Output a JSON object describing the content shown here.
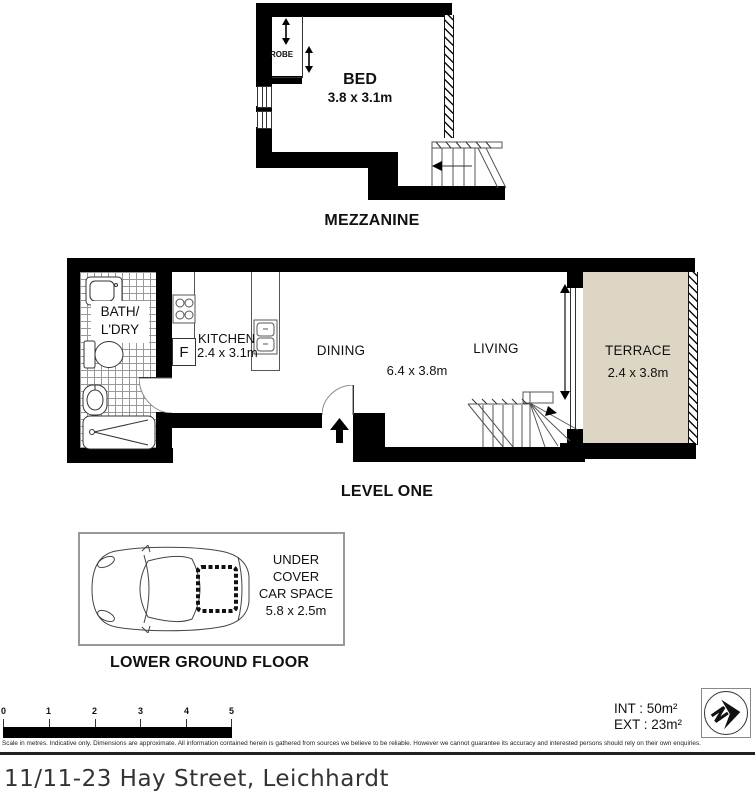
{
  "floors": {
    "mezzanine": {
      "title": "MEZZANINE",
      "bed": {
        "name": "BED",
        "dims": "3.8 x 3.1m"
      },
      "robe": {
        "name": "ROBE"
      }
    },
    "level_one": {
      "title": "LEVEL ONE",
      "bath": {
        "line1": "BATH/",
        "line2": "L'DRY"
      },
      "kitchen": {
        "name": "KITCHEN",
        "dims": "2.4 x 3.1m",
        "fridge": "F"
      },
      "dining": {
        "name": "DINING",
        "dims": "6.4 x 3.8m"
      },
      "living": {
        "name": "LIVING"
      },
      "terrace": {
        "name": "TERRACE",
        "dims": "2.4 x 3.8m"
      }
    },
    "lower_ground": {
      "title": "LOWER GROUND FLOOR",
      "car_space": {
        "line1": "UNDER",
        "line2": "COVER",
        "line3": "CAR SPACE",
        "dims": "5.8 x 2.5m"
      }
    }
  },
  "footer": {
    "scale_ticks": [
      "0",
      "1",
      "2",
      "3",
      "4",
      "5"
    ],
    "areas": {
      "int": "INT : 50m²",
      "ext": "EXT : 23m²"
    },
    "disclaimer": "Scale in metres. Indicative only. Dimensions are approximate. All information contained herein is gathered from sources we believe to be reliable. However we cannot guarantee its accuracy and interested persons should rely on their own enquiries.",
    "address": "11/11-23 Hay Street, Leichhardt"
  },
  "colors": {
    "wall": "#000000",
    "terrace_fill": "#ddd6c5",
    "tile_line": "#999999"
  }
}
